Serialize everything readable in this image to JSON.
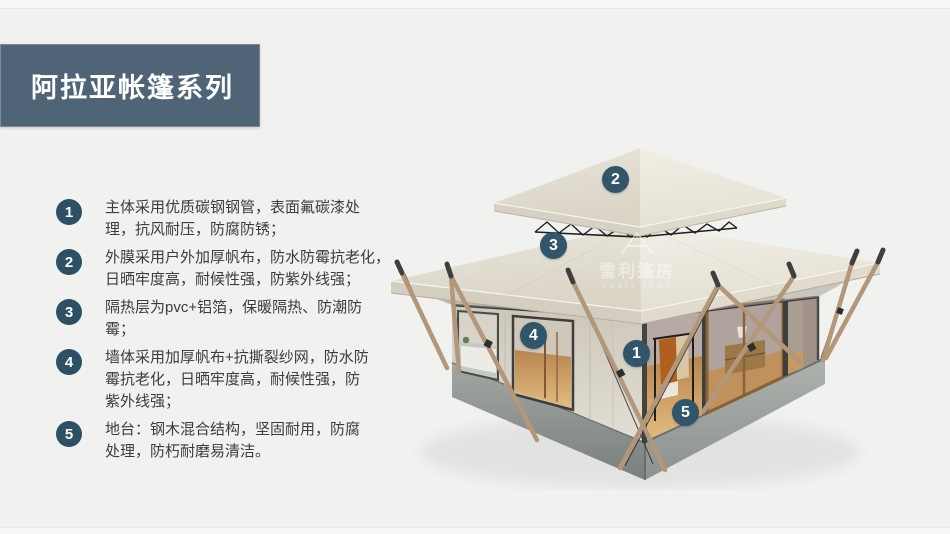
{
  "header": {
    "title": "阿拉亚帐篷系列"
  },
  "features": [
    {
      "num": "1",
      "text": "主体采用优质碳钢钢管，表面氟碳漆处\n理，抗风耐压，防腐防锈；"
    },
    {
      "num": "2",
      "text": "外膜采用户外加厚帆布，防水防霉抗老化，\n日晒牢度高，耐候性强，防紫外线强；"
    },
    {
      "num": "3",
      "text": "隔热层为pvc+铝箔，保暖隔热、防潮防\n霉；"
    },
    {
      "num": "4",
      "text": "墙体采用加厚帆布+抗撕裂纱网，防水防\n霉抗老化，日晒牢度高，耐候性强，防\n紫外线强；"
    },
    {
      "num": "5",
      "text": "地台：钢木混合结构，坚固耐用，防腐\n处理，防朽耐磨易清洁。"
    }
  ],
  "callouts": [
    {
      "num": "1"
    },
    {
      "num": "2"
    },
    {
      "num": "3"
    },
    {
      "num": "4"
    },
    {
      "num": "5"
    }
  ],
  "watermark": {
    "cn": "雪利篷房",
    "en": "XUELI TENT"
  },
  "colors": {
    "accent": "#4f6577",
    "list_badge": "#2e5064",
    "photo_badge": "#31566a",
    "background": "#f1f1f0"
  }
}
